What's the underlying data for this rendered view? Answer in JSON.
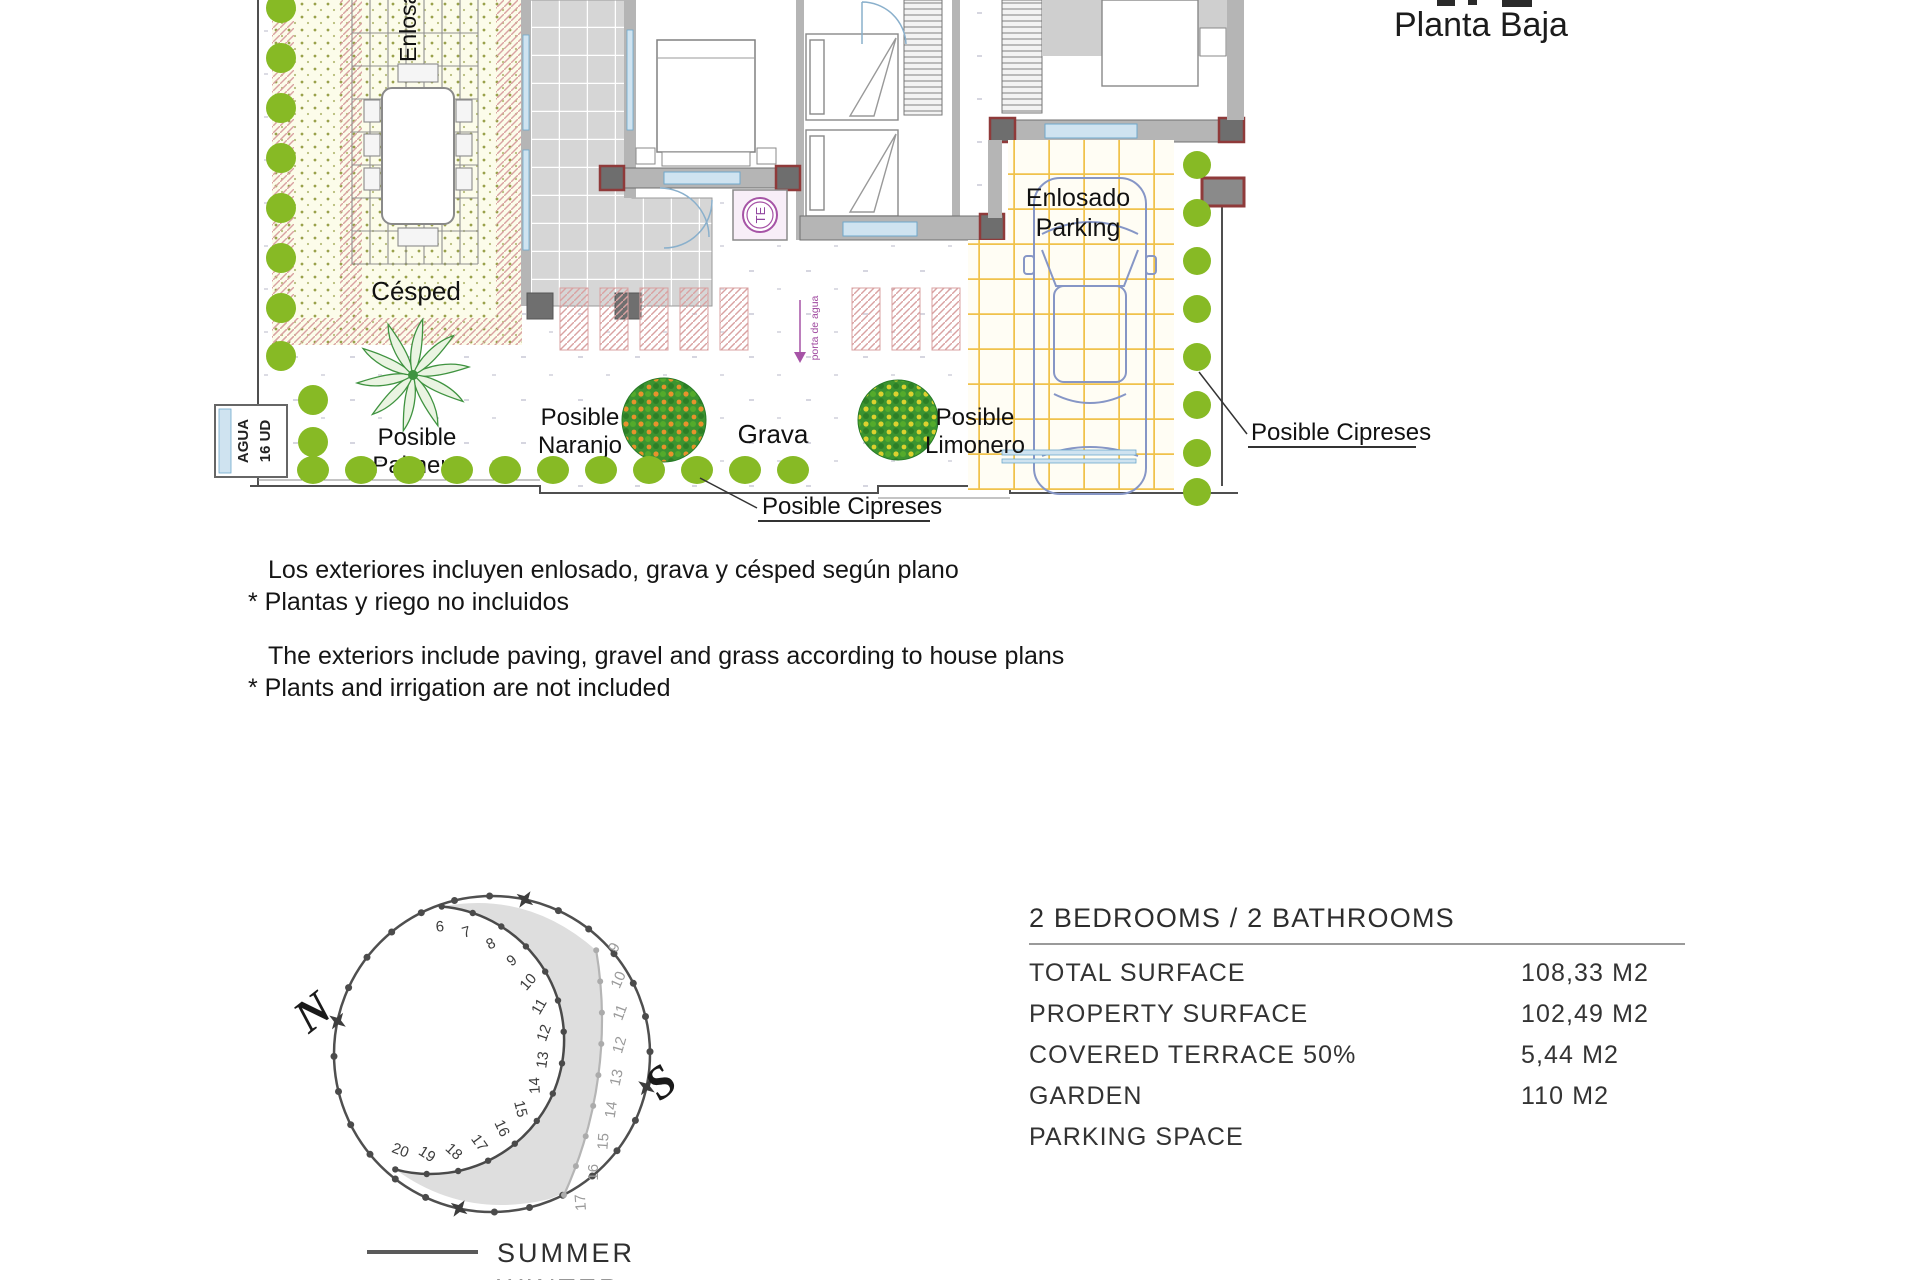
{
  "title": {
    "text": "Planta Baja"
  },
  "plan_labels": {
    "enlosado_vertical": "Enlosado",
    "cesped": "Césped",
    "grava": "Grava",
    "parking_line1": "Enlosado",
    "parking_line2": "Parking",
    "palmera_line1": "Posible",
    "palmera_line2": "Palmera",
    "naranjo_line1": "Posible",
    "naranjo_line2": "Naranjo",
    "limonero_line1": "Posible",
    "limonero_line2": "Limonero",
    "cipreses_bottom": "Posible Cipreses",
    "cipreses_right": "Posible Cipreses",
    "agua_line1": "AGUA",
    "agua_line2": "16 UD",
    "te": "TE",
    "water_note": "porta de agua"
  },
  "notes": {
    "es_line1": "Los exteriores incluyen enlosado, grava y césped según plano",
    "es_line2": "* Plantas y riego no incluidos",
    "en_line1": "The exteriors include paving, gravel and grass according to house plans",
    "en_line2": "* Plants and irrigation are not included"
  },
  "sun_diagram": {
    "north_label": "N",
    "south_label": "S",
    "summer_hours": [
      6,
      7,
      8,
      9,
      10,
      11,
      12,
      13,
      14,
      15,
      16,
      17,
      18,
      19,
      20
    ],
    "winter_hours": [
      9,
      10,
      11,
      12,
      13,
      14,
      15,
      16,
      17
    ],
    "legend": {
      "summer": "SUMMER",
      "winter": "WINTER"
    },
    "summer_color": "#4a4a4a",
    "winter_color": "#b5b5b5"
  },
  "details": {
    "heading": "2 BEDROOMS / 2 BATHROOMS",
    "rows": [
      {
        "label": "TOTAL SURFACE",
        "value": "108,33 M2"
      },
      {
        "label": "PROPERTY SURFACE",
        "value": "102,49 M2"
      },
      {
        "label": "COVERED TERRACE 50%",
        "value": "5,44 M2"
      },
      {
        "label": "GARDEN",
        "value": "110 M2"
      },
      {
        "label": "PARKING SPACE",
        "value": ""
      }
    ]
  },
  "colors": {
    "plant_green": "#87ba25",
    "tree_green_dark": "#2f8b2c",
    "orange_fruit": "#e8922c",
    "lemon_fruit": "#ddd12f",
    "parking_grid": "#f0c24b",
    "hatch_pink": "#d9a2a2",
    "accent_red": "#8f3a3a",
    "window_blue": "#6fa8cc",
    "purple": "#a653a6",
    "wall_gray": "#b5b5b5"
  }
}
